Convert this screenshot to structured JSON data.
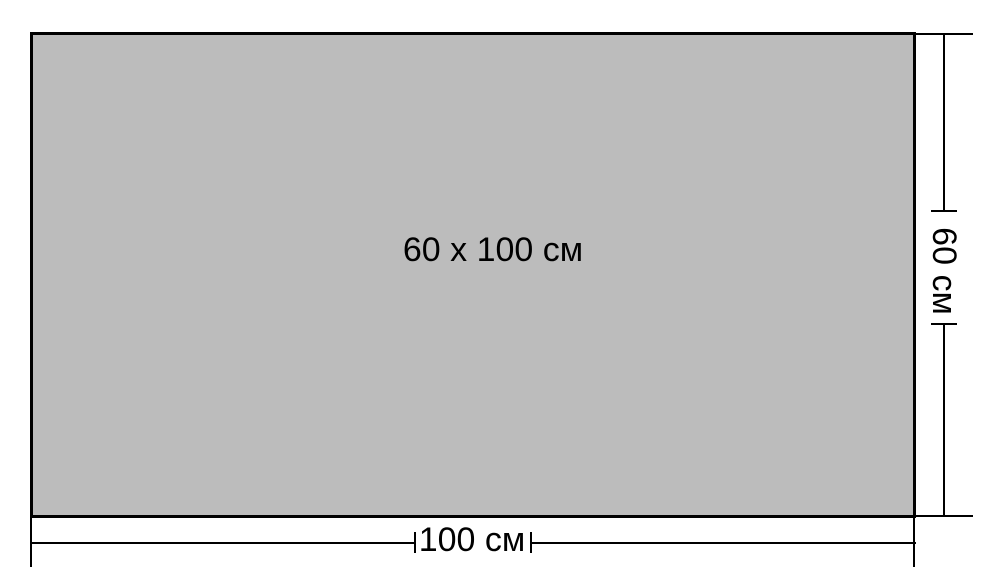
{
  "diagram": {
    "center_label": "60 x 100 см",
    "bottom_dimension": {
      "label": "100 см"
    },
    "right_dimension": {
      "label": "60 см"
    }
  },
  "colors": {
    "background": "#ffffff",
    "rect_fill": "#bcbcbc",
    "line": "#000000",
    "text": "#000000"
  }
}
